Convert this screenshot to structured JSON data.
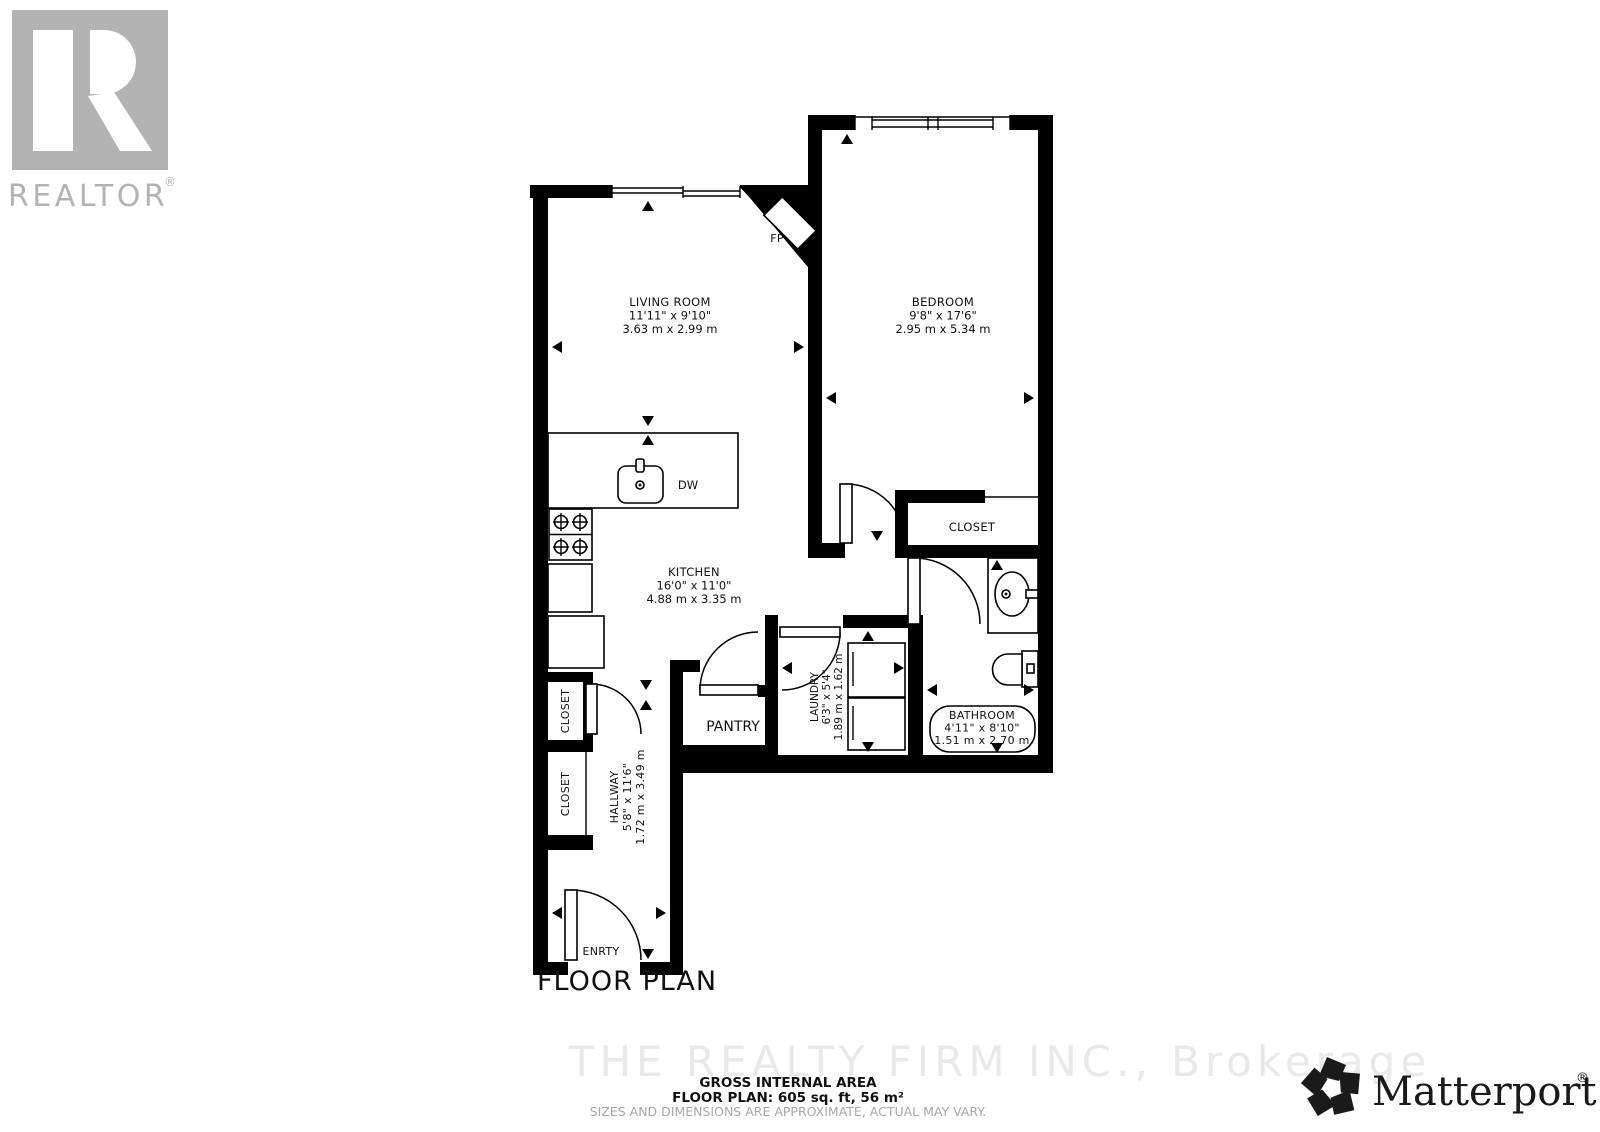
{
  "page": {
    "title": "FLOOR PLAN"
  },
  "branding": {
    "realtor": {
      "wordmark": "REALTOR",
      "registered": "®"
    },
    "matterport": {
      "wordmark": "Matterport",
      "registered": "®"
    },
    "watermark": "THE REALTY FIRM INC., Brokerage"
  },
  "rooms": [
    {
      "id": "living-room",
      "name": "LIVING ROOM",
      "imperial": "11'11\" x 9'10\"",
      "metric": "3.63 m x 2.99 m"
    },
    {
      "id": "bedroom",
      "name": "BEDROOM",
      "imperial": "9'8\" x 17'6\"",
      "metric": "2.95 m x 5.34 m"
    },
    {
      "id": "kitchen",
      "name": "KITCHEN",
      "imperial": "16'0\" x 11'0\"",
      "metric": "4.88 m x 3.35 m"
    },
    {
      "id": "hallway",
      "name": "HALLWAY",
      "imperial": "5'8\" x 11'6\"",
      "metric": "1.72 m x 3.49 m"
    },
    {
      "id": "laundry",
      "name": "LAUNDRY",
      "imperial": "6'3\" x 5'4\"",
      "metric": "1.89 m x 1.62 m"
    },
    {
      "id": "bathroom",
      "name": "BATHROOM",
      "imperial": "4'11\" x 8'10\"",
      "metric": "1.51 m x 2.70 m"
    }
  ],
  "labels": {
    "closet_upper": "CLOSET",
    "closet_lower": "CLOSET",
    "closet_bedroom": "CLOSET",
    "pantry": "PANTRY",
    "entry": "ENRTY",
    "fireplace": "FP",
    "dishwasher": "DW"
  },
  "footer": {
    "area_heading": "GROSS INTERNAL AREA",
    "area_value": "FLOOR PLAN: 605 sq. ft, 56 m²",
    "disclaimer": "SIZES AND DIMENSIONS ARE APPROXIMATE, ACTUAL MAY VARY."
  },
  "colors": {
    "wall": "#000000",
    "logo_gray": "#b3b3b3",
    "watermark_gray": "#e9e9e9",
    "disclaimer_gray": "#a8a8a8"
  }
}
